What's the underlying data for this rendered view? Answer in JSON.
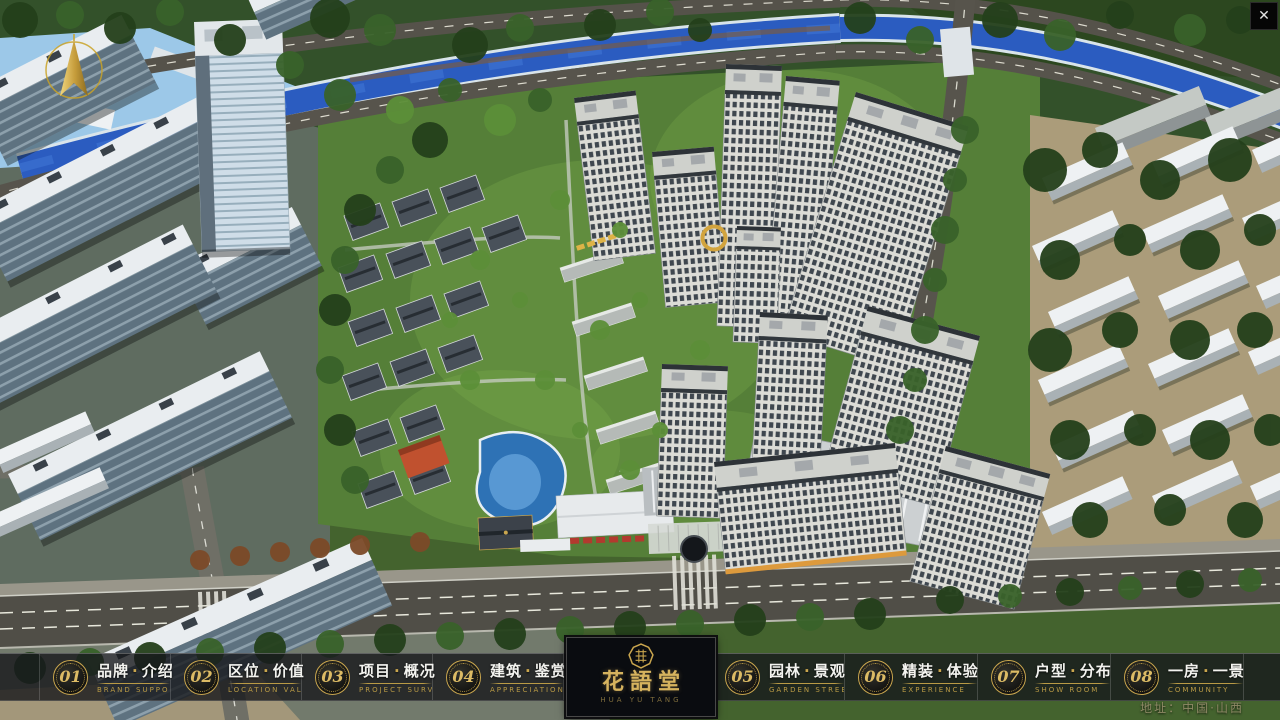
{
  "window": {
    "close_icon_glyph": "✕"
  },
  "navbar": {
    "dot": "·",
    "items": [
      {
        "num": "01",
        "zh_left": "品牌",
        "zh_right": "介绍",
        "en": "BRAND SUPPORT"
      },
      {
        "num": "02",
        "zh_left": "区位",
        "zh_right": "价值",
        "en": "LOCATION VALUE"
      },
      {
        "num": "03",
        "zh_left": "项目",
        "zh_right": "概况",
        "en": "PROJECT SURVEY"
      },
      {
        "num": "04",
        "zh_left": "建筑",
        "zh_right": "鉴赏",
        "en": "APPRECIATION"
      },
      {
        "num": "05",
        "zh_left": "园林",
        "zh_right": "景观",
        "en": "GARDEN STREET"
      },
      {
        "num": "06",
        "zh_left": "精装",
        "zh_right": "体验",
        "en": "EXPERIENCE"
      },
      {
        "num": "07",
        "zh_left": "户型",
        "zh_right": "分布",
        "en": "SHOW ROOM"
      },
      {
        "num": "08",
        "zh_left": "一房",
        "zh_right": "一景",
        "en": "COMMUNITY"
      }
    ],
    "logo": {
      "title": "花語堂",
      "subtitle": "HUA YU TANG"
    }
  },
  "footer": {
    "address": "地址：中国·山西"
  },
  "colors": {
    "gold": "#c9a64e",
    "river": "#2b5cc0",
    "lake": "#9cc8e8",
    "bar_bg": "#16181b"
  }
}
